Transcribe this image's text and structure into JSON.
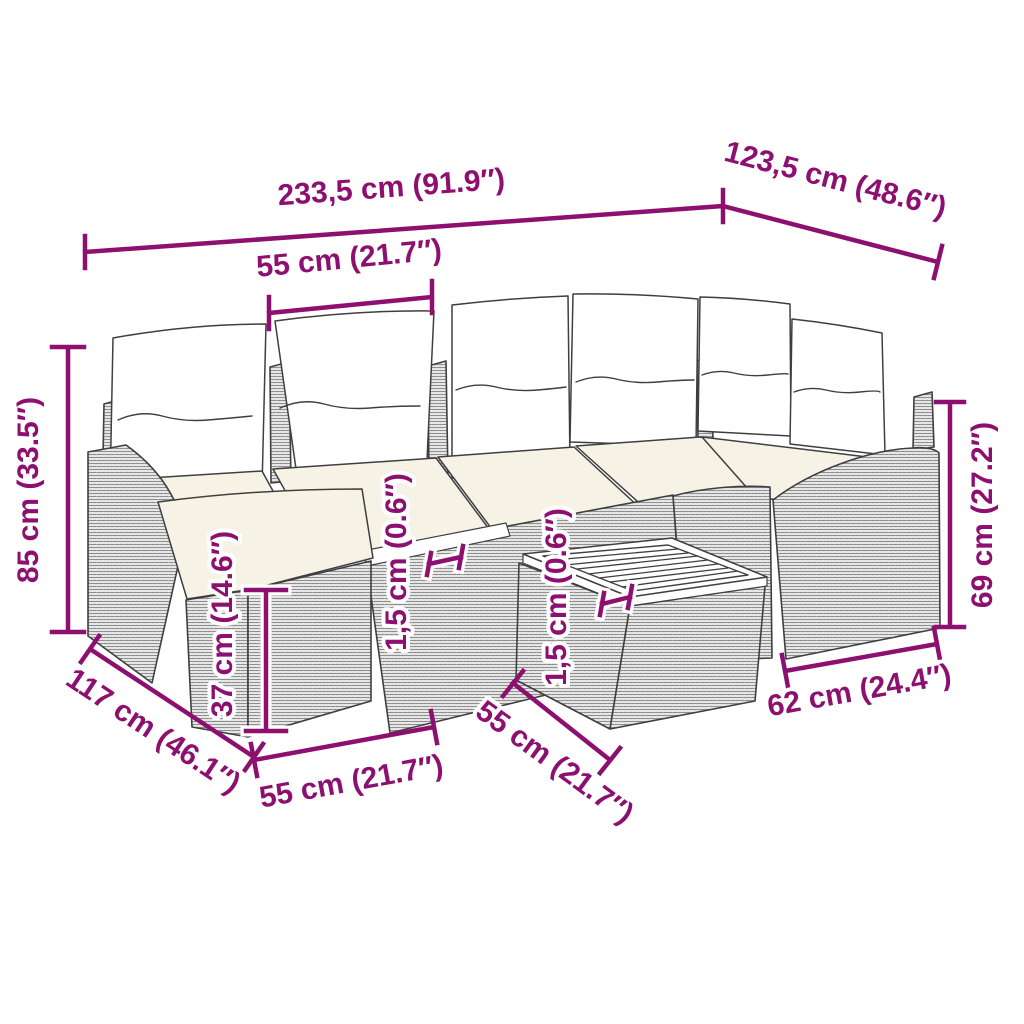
{
  "diagram": {
    "title": "7 piece rattan garden lounge set with cushions - dimension diagram",
    "style": {
      "accent_color": "#8D1070",
      "line_color": "#3F3F3F",
      "pillow_fill": "#FFFFFF",
      "seat_cushion_fill": "#F6F3E6",
      "background": "#FFFFFF"
    },
    "labels": {
      "overall_width": "233,5 cm (91.9″)",
      "corner_depth": "123,5 cm (48.6″)",
      "seat_width": "55 cm (21.7″)",
      "total_height": "85 cm (33.5″)",
      "arm_height": "69 cm (27.2″)",
      "seat_height": "37 cm (14.6″)",
      "frame_thickness": "1,5 cm (0.6″)",
      "tabletop_thickness": "1,5 cm (0.6″)",
      "sofa_depth": "117 cm (46.1″)",
      "footstool_width": "55 cm (21.7″)",
      "table_width": "55 cm (21.7″)",
      "end_section_width": "62 cm (24.4″)"
    }
  }
}
